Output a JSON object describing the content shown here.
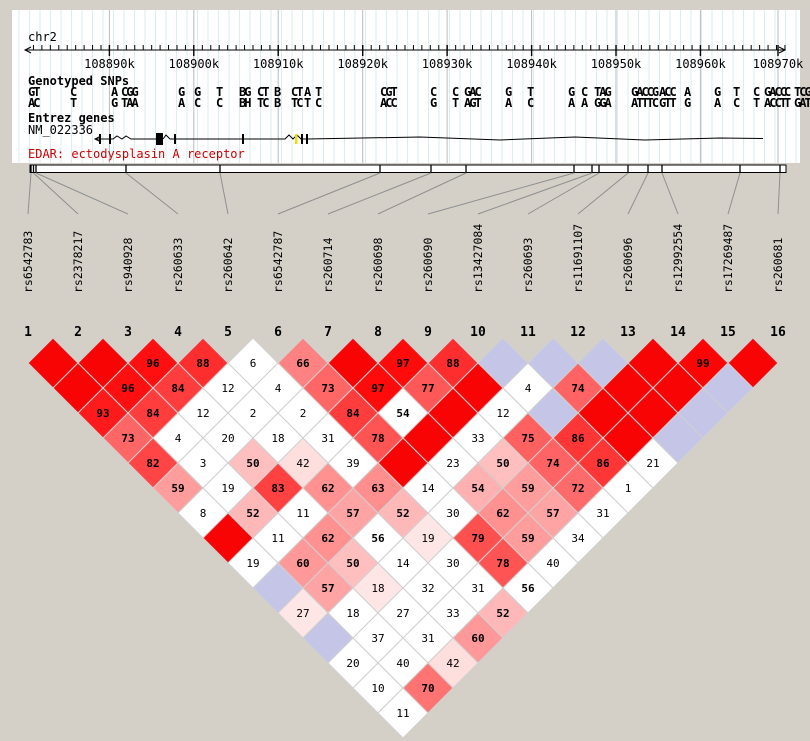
{
  "window": {
    "background": "#d4d0c8"
  },
  "panel": {
    "background": "#ffffff",
    "chromosome_label": "chr2",
    "grid": {
      "minor_color": "#d9edf2",
      "major_color": "#bbbbbb",
      "minor_step_px": 10.5
    },
    "ruler": {
      "y": 50,
      "x_start": 25,
      "x_end": 785,
      "minor_step_px": 8.444,
      "major_ticks": [
        {
          "label": "108890k",
          "x": 109.4
        },
        {
          "label": "108900k",
          "x": 193.8
        },
        {
          "label": "108910k",
          "x": 278.2
        },
        {
          "label": "108920k",
          "x": 362.7
        },
        {
          "label": "108930k",
          "x": 447.1
        },
        {
          "label": "108940k",
          "x": 531.6
        },
        {
          "label": "108950k",
          "x": 616.0
        },
        {
          "label": "108960k",
          "x": 700.4
        },
        {
          "label": "108970k",
          "x": 778.0
        }
      ]
    }
  },
  "tracks": {
    "snps_title": "Genotyped SNPs",
    "genes_title": "Entrez genes",
    "transcript_id": "NM_022336",
    "gene_caption": "EDAR: ectodysplasin A receptor",
    "caption_color": "#cc0000",
    "allele_top_color": "#0000ee",
    "allele_bottom_color": "#ee0000",
    "allele_groups": [
      {
        "x": 28,
        "top": "GT",
        "bottom": "AC"
      },
      {
        "x": 70,
        "top": "C",
        "bottom": "T"
      },
      {
        "x": 111,
        "top": "A",
        "bottom": "G"
      },
      {
        "x": 121,
        "top": "CGG",
        "bottom": "TAA"
      },
      {
        "x": 178,
        "top": "G",
        "bottom": "A"
      },
      {
        "x": 194,
        "top": "G",
        "bottom": "C"
      },
      {
        "x": 216,
        "top": "T",
        "bottom": "C"
      },
      {
        "x": 239,
        "top": "BG",
        "bottom": "BH"
      },
      {
        "x": 257,
        "top": "CT",
        "bottom": "TC"
      },
      {
        "x": 274,
        "top": "B",
        "bottom": "B"
      },
      {
        "x": 291,
        "top": "CT",
        "bottom": "TC"
      },
      {
        "x": 304,
        "top": "A",
        "bottom": "T"
      },
      {
        "x": 315,
        "top": "T",
        "bottom": "C"
      },
      {
        "x": 380,
        "top": "CGT",
        "bottom": "ACC"
      },
      {
        "x": 430,
        "top": "C",
        "bottom": "G"
      },
      {
        "x": 452,
        "top": "C",
        "bottom": "T"
      },
      {
        "x": 464,
        "top": "GAC",
        "bottom": "AGT"
      },
      {
        "x": 505,
        "top": "G",
        "bottom": "A"
      },
      {
        "x": 527,
        "top": "T",
        "bottom": "C"
      },
      {
        "x": 568,
        "top": "G",
        "bottom": "A"
      },
      {
        "x": 581,
        "top": "C",
        "bottom": "A"
      },
      {
        "x": 594,
        "top": "TAG",
        "bottom": "GGA"
      },
      {
        "x": 631,
        "top": "GACCG",
        "bottom": "ATTTC"
      },
      {
        "x": 659,
        "top": "ACC",
        "bottom": "GTT"
      },
      {
        "x": 684,
        "top": "A",
        "bottom": "G"
      },
      {
        "x": 714,
        "top": "G",
        "bottom": "A"
      },
      {
        "x": 733,
        "top": "T",
        "bottom": "C"
      },
      {
        "x": 753,
        "top": "C",
        "bottom": "T"
      },
      {
        "x": 764,
        "top": "GACC",
        "bottom": "ACCT"
      },
      {
        "x": 784,
        "top": "C",
        "bottom": "T"
      },
      {
        "x": 794,
        "top": "TCG",
        "bottom": "GAT"
      }
    ],
    "gene": {
      "line_y": 139,
      "start_x": 95,
      "end_x": 763,
      "exon_ticks": [
        100,
        110,
        175,
        243,
        302,
        307
      ],
      "exon_boxes": [
        [
          156,
          7
        ]
      ],
      "yellow_tick_x": 296,
      "wiggle_points": [
        [
          307,
          139
        ],
        [
          420,
          137
        ],
        [
          500,
          140
        ],
        [
          575,
          137
        ],
        [
          645,
          140
        ],
        [
          720,
          138
        ],
        [
          763,
          138.5
        ]
      ]
    }
  },
  "snps": [
    {
      "id": "rs6542783",
      "tick_x": 31
    },
    {
      "id": "rs2378217",
      "tick_x": 33.5
    },
    {
      "id": "rs940928",
      "tick_x": 36
    },
    {
      "id": "rs260633",
      "tick_x": 126
    },
    {
      "id": "rs260642",
      "tick_x": 220
    },
    {
      "id": "rs6542787",
      "tick_x": 380
    },
    {
      "id": "rs260714",
      "tick_x": 431
    },
    {
      "id": "rs260698",
      "tick_x": 466
    },
    {
      "id": "rs260690",
      "tick_x": 574
    },
    {
      "id": "rs13427084",
      "tick_x": 592
    },
    {
      "id": "rs260693",
      "tick_x": 599
    },
    {
      "id": "rs11691107",
      "tick_x": 628
    },
    {
      "id": "rs260696",
      "tick_x": 648
    },
    {
      "id": "rs12992554",
      "tick_x": 662
    },
    {
      "id": "rs17269487",
      "tick_x": 740
    },
    {
      "id": "rs260681",
      "tick_x": 780
    }
  ],
  "band": {
    "x_start": 30,
    "x_end": 786,
    "y": 165,
    "height": 7.5
  },
  "chart_data": {
    "type": "heatmap",
    "description": "Pairwise LD plot: values are D' x 100. Solid red = 100 (strong LD, no number shown), lavender = high D' with low LOD, white = low LOD, pink shades scale with D'.",
    "columns": [
      "1",
      "2",
      "3",
      "4",
      "5",
      "6",
      "7",
      "8",
      "9",
      "10",
      "11",
      "12",
      "13",
      "14",
      "15",
      "16"
    ],
    "snp_ids": [
      "rs6542783",
      "rs2378217",
      "rs940928",
      "rs260633",
      "rs260642",
      "rs6542787",
      "rs260714",
      "rs260698",
      "rs260690",
      "rs13427084",
      "rs260693",
      "rs11691107",
      "rs260696",
      "rs12992554",
      "rs17269487",
      "rs260681"
    ],
    "legend": {
      "strong_ld_color": "#f90404",
      "low_lod_high_dprime_color": "#c5c5e8",
      "low_lod_color": "#ffffff",
      "value_color_high": "#000000",
      "value_color_low": "#848484"
    },
    "rows": [
      {
        "distance": 1,
        "cells": [
          [
            "R",
            null
          ],
          [
            "R",
            null
          ],
          [
            "P",
            96
          ],
          [
            "P",
            88
          ],
          [
            "W",
            6
          ],
          [
            "P",
            66
          ],
          [
            "R",
            null
          ],
          [
            "P",
            97
          ],
          [
            "P",
            88
          ],
          [
            "B",
            null
          ],
          [
            "B",
            null
          ],
          [
            "B",
            null
          ],
          [
            "R",
            null
          ],
          [
            "P",
            99
          ],
          [
            "R",
            null
          ]
        ]
      },
      {
        "distance": 2,
        "cells": [
          [
            "R",
            null
          ],
          [
            "P",
            96
          ],
          [
            "P",
            84
          ],
          [
            "W",
            12
          ],
          [
            "W",
            4
          ],
          [
            "P",
            73
          ],
          [
            "P",
            97
          ],
          [
            "P",
            77
          ],
          [
            "R",
            null
          ],
          [
            "W",
            4
          ],
          [
            "P",
            74
          ],
          [
            "R",
            null
          ],
          [
            "R",
            null
          ],
          [
            "B",
            null
          ]
        ]
      },
      {
        "distance": 3,
        "cells": [
          [
            "P",
            93
          ],
          [
            "P",
            84
          ],
          [
            "W",
            12
          ],
          [
            "W",
            2
          ],
          [
            "W",
            2
          ],
          [
            "P",
            84
          ],
          [
            "W",
            54
          ],
          [
            "R",
            null
          ],
          [
            "W",
            12
          ],
          [
            "B",
            null
          ],
          [
            "R",
            null
          ],
          [
            "R",
            null
          ],
          [
            "B",
            null
          ]
        ]
      },
      {
        "distance": 4,
        "cells": [
          [
            "P",
            73
          ],
          [
            "W",
            4
          ],
          [
            "W",
            20
          ],
          [
            "W",
            18
          ],
          [
            "W",
            31
          ],
          [
            "P",
            78
          ],
          [
            "R",
            null
          ],
          [
            "W",
            33
          ],
          [
            "P",
            75
          ],
          [
            "P",
            86
          ],
          [
            "R",
            null
          ],
          [
            "B",
            null
          ]
        ]
      },
      {
        "distance": 5,
        "cells": [
          [
            "P",
            82
          ],
          [
            "W",
            3
          ],
          [
            "P",
            50
          ],
          [
            "P",
            42
          ],
          [
            "W",
            39
          ],
          [
            "R",
            null
          ],
          [
            "W",
            23
          ],
          [
            "P",
            50
          ],
          [
            "P",
            74
          ],
          [
            "P",
            86
          ],
          [
            "W",
            21
          ]
        ]
      },
      {
        "distance": 6,
        "cells": [
          [
            "P",
            59
          ],
          [
            "W",
            19
          ],
          [
            "P",
            83
          ],
          [
            "P",
            62
          ],
          [
            "P",
            63
          ],
          [
            "W",
            14
          ],
          [
            "P",
            54
          ],
          [
            "P",
            59
          ],
          [
            "P",
            72
          ],
          [
            "W",
            1
          ]
        ]
      },
      {
        "distance": 7,
        "cells": [
          [
            "W",
            8
          ],
          [
            "P",
            52
          ],
          [
            "W",
            11
          ],
          [
            "P",
            57
          ],
          [
            "P",
            52
          ],
          [
            "W",
            30
          ],
          [
            "P",
            62
          ],
          [
            "P",
            57
          ],
          [
            "W",
            31
          ]
        ]
      },
      {
        "distance": 8,
        "cells": [
          [
            "R",
            null
          ],
          [
            "W",
            11
          ],
          [
            "P",
            62
          ],
          [
            "W",
            56
          ],
          [
            "P",
            19
          ],
          [
            "P",
            79
          ],
          [
            "P",
            59
          ],
          [
            "W",
            34
          ]
        ]
      },
      {
        "distance": 9,
        "cells": [
          [
            "W",
            19
          ],
          [
            "P",
            60
          ],
          [
            "P",
            50
          ],
          [
            "W",
            14
          ],
          [
            "W",
            30
          ],
          [
            "P",
            78
          ],
          [
            "W",
            40
          ]
        ]
      },
      {
        "distance": 10,
        "cells": [
          [
            "B",
            null
          ],
          [
            "P",
            57
          ],
          [
            "P",
            18
          ],
          [
            "W",
            32
          ],
          [
            "W",
            31
          ],
          [
            "W",
            56
          ]
        ]
      },
      {
        "distance": 11,
        "cells": [
          [
            "P",
            27
          ],
          [
            "W",
            18
          ],
          [
            "W",
            27
          ],
          [
            "W",
            33
          ],
          [
            "P",
            52
          ]
        ]
      },
      {
        "distance": 12,
        "cells": [
          [
            "B",
            null
          ],
          [
            "W",
            37
          ],
          [
            "W",
            31
          ],
          [
            "P",
            60
          ]
        ]
      },
      {
        "distance": 13,
        "cells": [
          [
            "W",
            20
          ],
          [
            "W",
            40
          ],
          [
            "P",
            42
          ]
        ]
      },
      {
        "distance": 14,
        "cells": [
          [
            "W",
            10
          ],
          [
            "P",
            70
          ]
        ]
      },
      {
        "distance": 15,
        "cells": [
          [
            "W",
            11
          ]
        ]
      }
    ]
  }
}
